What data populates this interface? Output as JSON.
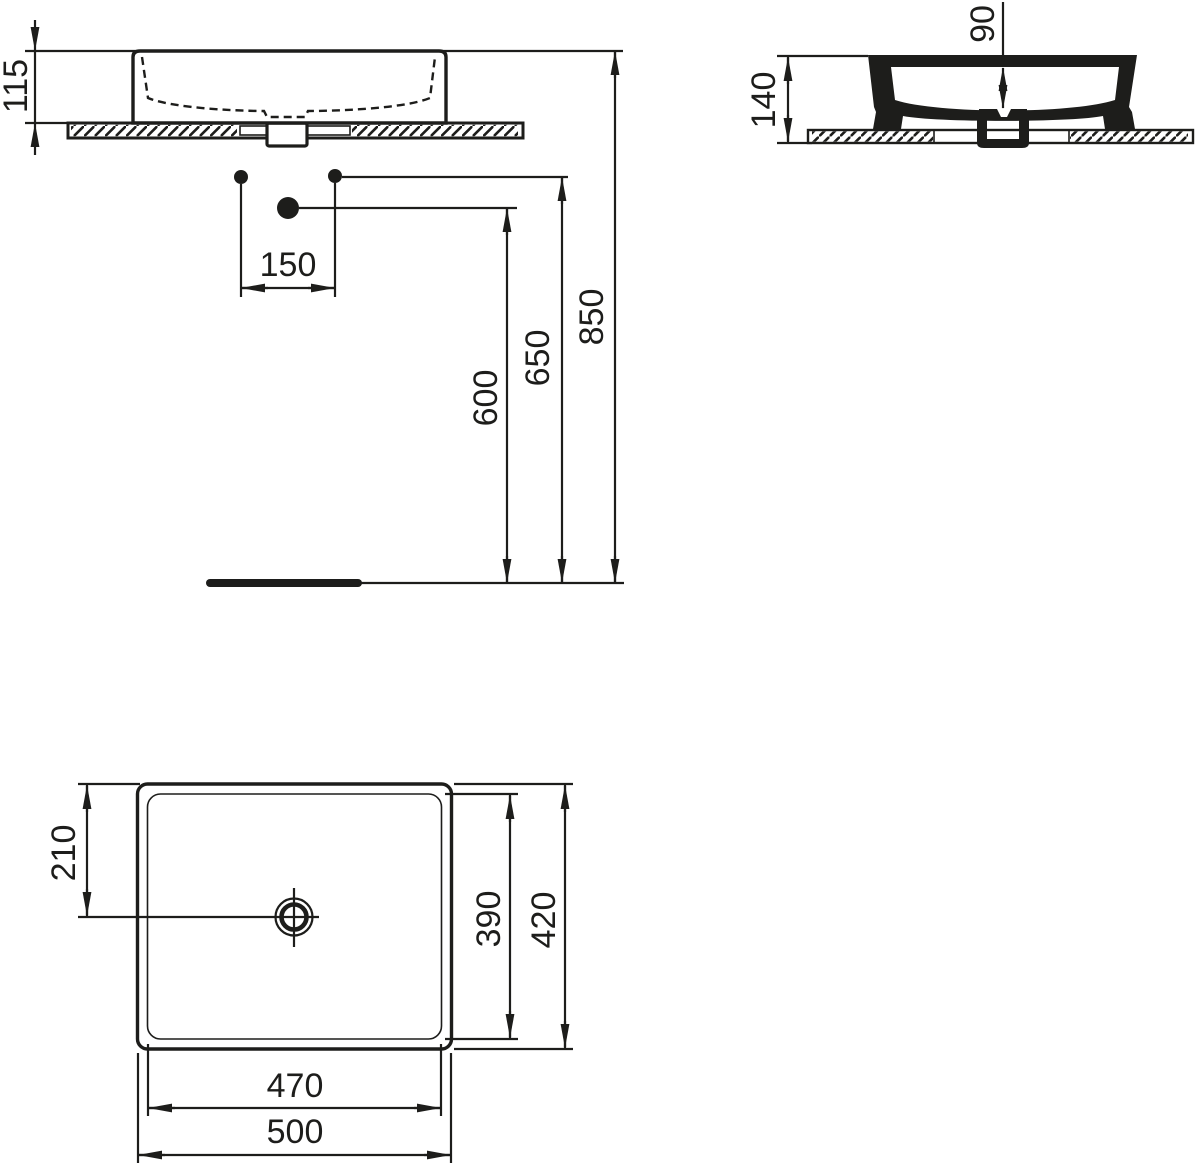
{
  "drawing": {
    "background": "#ffffff",
    "line_color": "#1d1d1b"
  },
  "dims": {
    "front": {
      "basin_height": "115",
      "hole_spacing": "150",
      "drain_line_height": "600",
      "fixing_line_height": "650",
      "rim_height": "850"
    },
    "side": {
      "total_height": "140",
      "bowl_depth": "90"
    },
    "plan": {
      "drain_offset": "210",
      "inner_depth": "390",
      "outer_depth": "420",
      "inner_width": "470",
      "outer_width": "500"
    }
  }
}
